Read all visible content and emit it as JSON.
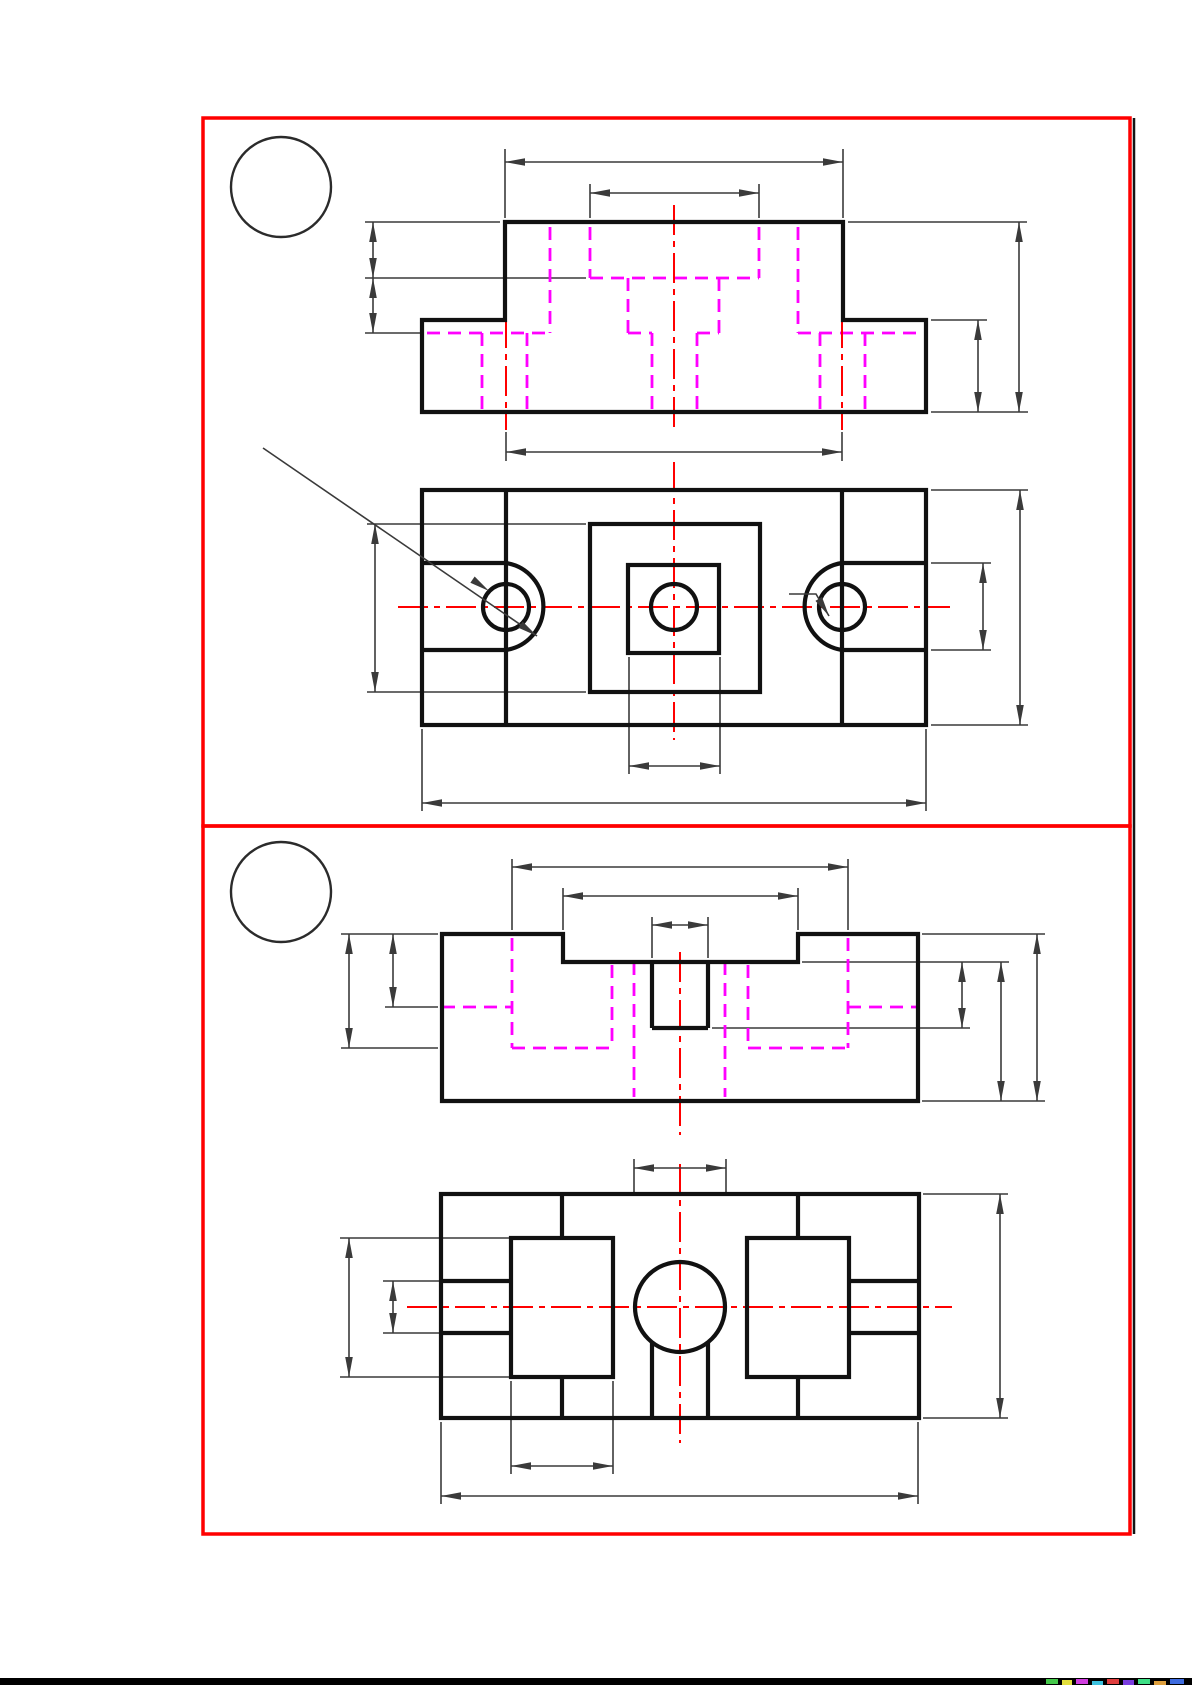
{
  "page": {
    "width": 1192,
    "height": 1685,
    "background": "#ffffff"
  },
  "colors": {
    "outline": "#111111",
    "hidden": "#ff00ff",
    "centerline": "#ff0000",
    "dimension": "#3a3a3a",
    "panel_border": "#ff0000"
  },
  "panels": [
    {
      "name": "panel-1",
      "border": [
        203,
        118,
        1130,
        826
      ],
      "balloon": {
        "cx": 281,
        "cy": 187,
        "r": 50,
        "label": ""
      },
      "views": [
        {
          "name": "front-view-1",
          "outline_paths": [
            "M505,222 H843 V320 H926 V412 H422 V320 H505 Z"
          ],
          "bold_segments": [],
          "rects": [],
          "circles": [],
          "arc_paths": [],
          "hidden_segments": [
            [
              550,
              227,
              550,
              333
            ],
            [
              798,
              227,
              798,
              333
            ],
            [
              590,
              227,
              590,
              278
            ],
            [
              759,
              227,
              759,
              278
            ],
            [
              590,
              278,
              759,
              278
            ],
            [
              628,
              278,
              628,
              333
            ],
            [
              719,
              278,
              719,
              333
            ],
            [
              427,
              333,
              550,
              333
            ],
            [
              628,
              333,
              652,
              333
            ],
            [
              697,
              333,
              719,
              333
            ],
            [
              798,
              333,
              922,
              333
            ],
            [
              482,
              333,
              482,
              412
            ],
            [
              527,
              333,
              527,
              412
            ],
            [
              652,
              333,
              652,
              412
            ],
            [
              697,
              333,
              697,
              412
            ],
            [
              820,
              333,
              820,
              412
            ],
            [
              865,
              333,
              865,
              412
            ]
          ],
          "center_segments": [
            [
              506,
              318,
              506,
              430
            ],
            [
              674,
              205,
              674,
              430
            ],
            [
              842,
              318,
              842,
              430
            ]
          ],
          "dimensions": [
            [
              505,
              162,
              843,
              162
            ],
            [
              590,
              193,
              759,
              193
            ],
            [
              373,
              222,
              373,
              278
            ],
            [
              373,
              278,
              373,
              333
            ],
            [
              978,
              320,
              978,
              412
            ],
            [
              1019,
              222,
              1019,
              412
            ],
            [
              506,
              452,
              842,
              452
            ]
          ],
          "extension_segments": [
            [
              505,
              149,
              505,
              218
            ],
            [
              843,
              149,
              843,
              218
            ],
            [
              590,
              184,
              590,
              218
            ],
            [
              759,
              184,
              759,
              218
            ],
            [
              365,
              222,
              500,
              222
            ],
            [
              365,
              278,
              586,
              278
            ],
            [
              365,
              333,
              423,
              333
            ],
            [
              848,
              222,
              1027,
              222
            ],
            [
              931,
              320,
              987,
              320
            ],
            [
              931,
              412,
              1028,
              412
            ],
            [
              506,
              432,
              506,
              461
            ],
            [
              842,
              432,
              842,
              461
            ]
          ],
          "leaders": []
        },
        {
          "name": "top-view-1",
          "outline_paths": [],
          "bold_segments": [
            [
              506,
              490,
              506,
              725
            ],
            [
              842,
              490,
              842,
              725
            ],
            [
              422,
              563,
              506,
              563
            ],
            [
              422,
              650,
              506,
              650
            ],
            [
              842,
              563,
              926,
              563
            ],
            [
              842,
              650,
              926,
              650
            ]
          ],
          "rects": [
            [
              422,
              490,
              504,
              235
            ],
            [
              590,
              524,
              170,
              168
            ],
            [
              628,
              565,
              91,
              88
            ]
          ],
          "circles": [
            [
              506,
              607,
              23
            ],
            [
              674,
              607,
              23
            ],
            [
              842,
              607,
              23
            ]
          ],
          "arc_paths": [
            "M506,563 A44 44 0 0 1 506,650",
            "M842,563 A44 44 0 0 0 842,650"
          ],
          "hidden_segments": [],
          "center_segments": [
            [
              398,
              607,
              950,
              607
            ],
            [
              506,
              556,
              506,
              658
            ],
            [
              674,
              462,
              674,
              740
            ],
            [
              842,
              556,
              842,
              658
            ]
          ],
          "dimensions": [
            [
              375,
              524,
              375,
              692
            ],
            [
              983,
              563,
              983,
              650
            ],
            [
              1020,
              490,
              1020,
              725
            ],
            [
              629,
              766,
              720,
              766
            ],
            [
              422,
              803,
              926,
              803
            ]
          ],
          "extension_segments": [
            [
              367,
              524,
              586,
              524
            ],
            [
              367,
              692,
              586,
              692
            ],
            [
              931,
              563,
              991,
              563
            ],
            [
              931,
              650,
              991,
              650
            ],
            [
              931,
              490,
              1028,
              490
            ],
            [
              931,
              725,
              1028,
              725
            ],
            [
              629,
              657,
              629,
              774
            ],
            [
              720,
              657,
              720,
              774
            ],
            [
              422,
              729,
              422,
              811
            ],
            [
              926,
              729,
              926,
              811
            ]
          ],
          "leaders": [
            {
              "points": [
                [
                  263,
                  448
                ],
                [
                  537,
                  636
                ]
              ],
              "arrows": [
                [
                  489,
                  591,
                  34.5
                ],
                [
                  537,
                  636,
                  34.5
                ]
              ]
            },
            {
              "points": [
                [
                  789,
                  594
                ],
                [
                  816,
                  594
                ],
                [
                  829,
                  616
                ]
              ],
              "arrows": [
                [
                  829,
                  616,
                  59
                ]
              ]
            }
          ]
        }
      ]
    },
    {
      "name": "panel-2",
      "border": [
        203,
        826,
        1130,
        1534
      ],
      "balloon": {
        "cx": 281,
        "cy": 892,
        "r": 50,
        "label": ""
      },
      "views": [
        {
          "name": "front-view-2",
          "outline_paths": [
            "M442,934 H563 V962 H798 V934 H918 V1101 H442 Z"
          ],
          "bold_segments": [
            [
              652,
              962,
              652,
              1028
            ],
            [
              708,
              962,
              708,
              1028
            ],
            [
              652,
              1028,
              708,
              1028
            ]
          ],
          "rects": [],
          "circles": [],
          "arc_paths": [],
          "hidden_segments": [
            [
              512,
              938,
              512,
              1048
            ],
            [
              848,
              938,
              848,
              1048
            ],
            [
              612,
              965,
              612,
              1048
            ],
            [
              748,
              965,
              748,
              1048
            ],
            [
              634,
              962,
              634,
              1097
            ],
            [
              725,
              962,
              725,
              1097
            ],
            [
              442,
              1007,
              512,
              1007
            ],
            [
              848,
              1007,
              918,
              1007
            ],
            [
              512,
              1048,
              612,
              1048
            ],
            [
              748,
              1048,
              848,
              1048
            ]
          ],
          "center_segments": [
            [
              680,
              952,
              680,
              1135
            ]
          ],
          "dimensions": [
            [
              512,
              867,
              848,
              867
            ],
            [
              563,
              896,
              798,
              896
            ],
            [
              652,
              925,
              708,
              925
            ],
            [
              349,
              934,
              349,
              1048
            ],
            [
              393,
              934,
              393,
              1007
            ],
            [
              962,
              962,
              962,
              1028
            ],
            [
              1001,
              962,
              1001,
              1101
            ],
            [
              1037,
              934,
              1037,
              1101
            ]
          ],
          "extension_segments": [
            [
              512,
              859,
              512,
              930
            ],
            [
              848,
              859,
              848,
              930
            ],
            [
              563,
              888,
              563,
              930
            ],
            [
              798,
              888,
              798,
              930
            ],
            [
              652,
              917,
              652,
              958
            ],
            [
              708,
              917,
              708,
              958
            ],
            [
              341,
              934,
              438,
              934
            ],
            [
              385,
              1007,
              438,
              1007
            ],
            [
              341,
              1048,
              438,
              1048
            ],
            [
              922,
              934,
              1045,
              934
            ],
            [
              802,
              962,
              1009,
              962
            ],
            [
              712,
              1028,
              970,
              1028
            ],
            [
              922,
              1101,
              1045,
              1101
            ]
          ],
          "leaders": []
        },
        {
          "name": "bottom-view-2",
          "outline_paths": [],
          "bold_segments": [
            [
              562,
              1194,
              562,
              1238
            ],
            [
              562,
              1377,
              562,
              1418
            ],
            [
              798,
              1194,
              798,
              1238
            ],
            [
              798,
              1377,
              798,
              1418
            ],
            [
              441,
              1281,
              511,
              1281
            ],
            [
              441,
              1333,
              511,
              1333
            ],
            [
              849,
              1281,
              919,
              1281
            ],
            [
              849,
              1333,
              919,
              1333
            ],
            [
              652,
              1342,
              652,
              1418
            ],
            [
              708,
              1342,
              708,
              1418
            ]
          ],
          "rects": [
            [
              441,
              1194,
              478,
              224
            ],
            [
              511,
              1238,
              102,
              139
            ],
            [
              747,
              1238,
              102,
              139
            ]
          ],
          "circles": [
            [
              680,
              1307,
              45
            ]
          ],
          "arc_paths": [],
          "hidden_segments": [],
          "center_segments": [
            [
              680,
              1164,
              680,
              1443
            ],
            [
              407,
              1307,
              952,
              1307
            ]
          ],
          "dimensions": [
            [
              634,
              1168,
              726,
              1168
            ],
            [
              349,
              1238,
              349,
              1377
            ],
            [
              393,
              1281,
              393,
              1333
            ],
            [
              1000,
              1194,
              1000,
              1418
            ],
            [
              511,
              1466,
              613,
              1466
            ],
            [
              441,
              1496,
              918,
              1496
            ]
          ],
          "extension_segments": [
            [
              634,
              1159,
              634,
              1196
            ],
            [
              726,
              1159,
              726,
              1196
            ],
            [
              340,
              1238,
              511,
              1238
            ],
            [
              383,
              1281,
              441,
              1281
            ],
            [
              383,
              1333,
              441,
              1333
            ],
            [
              340,
              1377,
              511,
              1377
            ],
            [
              923,
              1194,
              1008,
              1194
            ],
            [
              923,
              1418,
              1008,
              1418
            ],
            [
              511,
              1381,
              511,
              1474
            ],
            [
              613,
              1381,
              613,
              1474
            ],
            [
              441,
              1422,
              441,
              1504
            ],
            [
              918,
              1422,
              918,
              1504
            ]
          ],
          "leaders": []
        }
      ]
    }
  ],
  "extras": {
    "right_edge_line": [
      1134,
      118,
      1134,
      1534
    ],
    "bottom_bar": [
      0,
      1678,
      1192,
      7
    ],
    "noise_strip": [
      [
        1046,
        1679,
        12,
        5,
        "#44c84a"
      ],
      [
        1062,
        1680,
        10,
        5,
        "#e2df3d"
      ],
      [
        1076,
        1679,
        12,
        5,
        "#d03ddf"
      ],
      [
        1092,
        1681,
        11,
        4,
        "#3dc2df"
      ],
      [
        1107,
        1679,
        12,
        5,
        "#df3d3d"
      ],
      [
        1123,
        1680,
        11,
        5,
        "#7a3ddf"
      ],
      [
        1138,
        1679,
        12,
        5,
        "#3ddf85"
      ],
      [
        1154,
        1681,
        12,
        4,
        "#dfa03d"
      ],
      [
        1170,
        1679,
        14,
        5,
        "#3d6bdf"
      ]
    ]
  }
}
